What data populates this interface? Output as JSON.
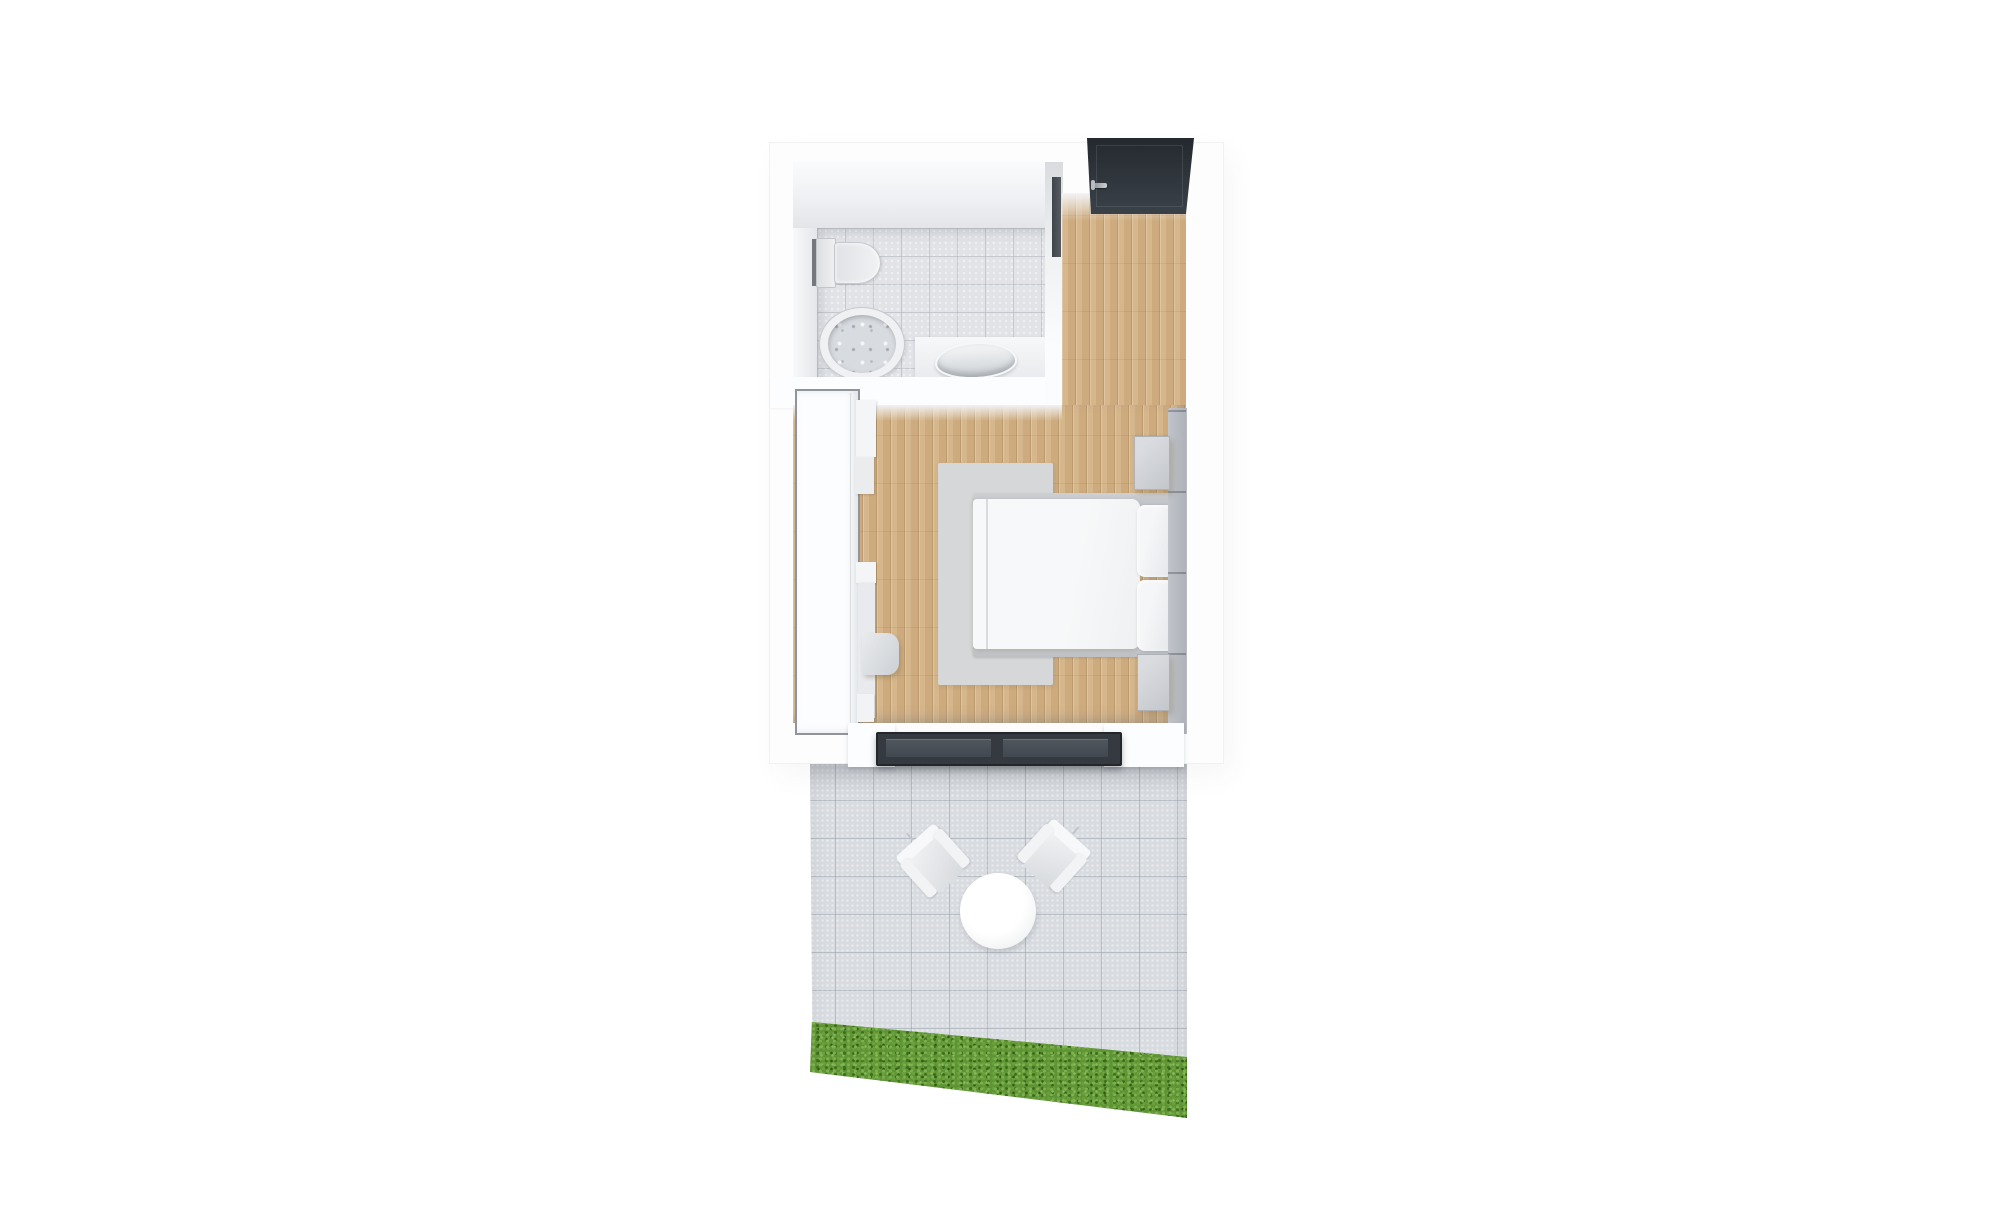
{
  "scene": {
    "label": "3D rendered floor plan of a studio suite with terrace",
    "background_color": "#ffffff",
    "unit": {
      "label": "Suite",
      "wall_color": "#fdfdfe",
      "entry": {
        "label": "Entry",
        "door": {
          "label": "Entrance door",
          "color": "#2e343a"
        },
        "handle": {
          "label": "Door handle",
          "color": "#b6bac0"
        }
      },
      "bathroom": {
        "label": "Bathroom",
        "floor_color": "#e1e3e7",
        "fixtures": {
          "toilet": {
            "label": "Wall-hung toilet"
          },
          "tub": {
            "label": "Round shower tub"
          },
          "sink": {
            "label": "Vessel washbasin"
          },
          "counter": {
            "label": "Washbasin counter"
          },
          "pocket_door": {
            "label": "Bathroom sliding door",
            "color": "#4a5056"
          }
        }
      },
      "bedroom": {
        "label": "Bedroom",
        "floor_color": "#d3b184",
        "furniture": {
          "wardrobe": {
            "label": "Wardrobe"
          },
          "shelves": {
            "label": "Shelf unit"
          },
          "desk": {
            "label": "Desk"
          },
          "desk_chair": {
            "label": "Desk chair"
          },
          "rug": {
            "label": "Rug",
            "color": "#d5d7d9"
          },
          "bed": {
            "label": "Double bed"
          },
          "pillow_1": {
            "label": "Pillow"
          },
          "pillow_2": {
            "label": "Pillow"
          },
          "headboard": {
            "label": "Upholstered headboard"
          },
          "nightstand_1": {
            "label": "Nightstand"
          },
          "nightstand_2": {
            "label": "Nightstand"
          }
        },
        "patio_door": {
          "label": "Sliding glass door",
          "color": "#343a40"
        }
      }
    },
    "patio": {
      "label": "Terrace",
      "tile_color": "#d8dce1",
      "items": {
        "table": {
          "label": "Round outdoor table"
        },
        "chair_left": {
          "label": "Outdoor armchair"
        },
        "chair_right": {
          "label": "Outdoor armchair"
        }
      },
      "lawn": {
        "label": "Lawn strip",
        "color": "#5e9336"
      }
    }
  }
}
